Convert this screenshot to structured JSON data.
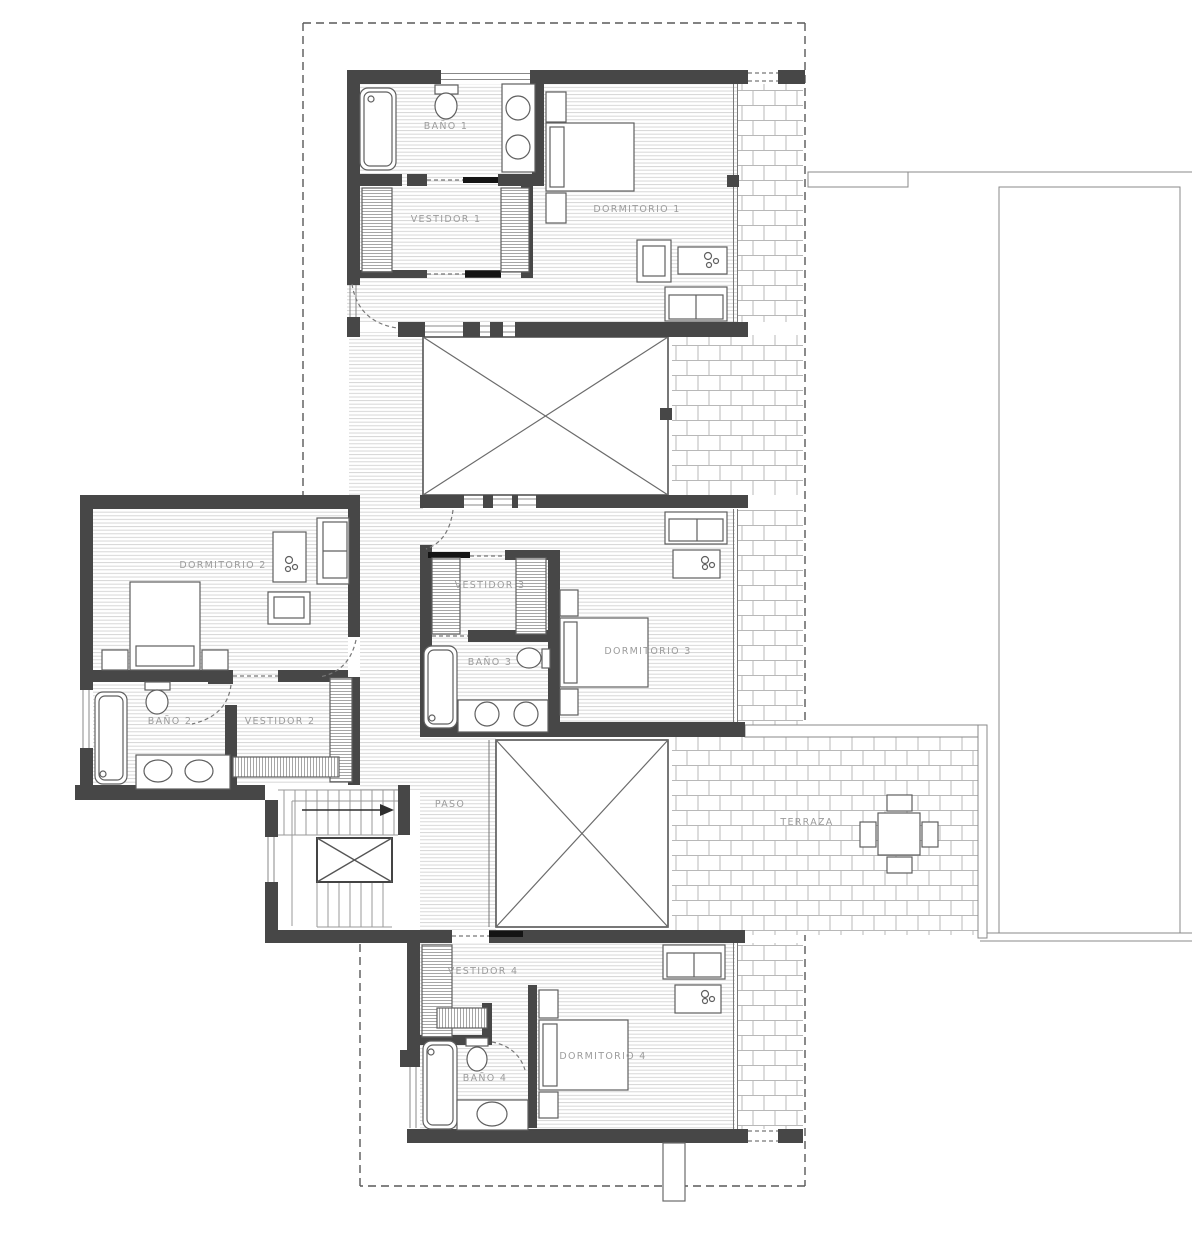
{
  "rooms": {
    "bano1": "BAÑO 1",
    "vestidor1": "VESTIDOR 1",
    "dormitorio1": "DORMITORIO 1",
    "dormitorio2": "DORMITORIO 2",
    "bano2": "BAÑO 2",
    "vestidor2": "VESTIDOR 2",
    "vestidor3": "VESTIDOR 3",
    "bano3": "BAÑO 3",
    "dormitorio3": "DORMITORIO 3",
    "paso": "PASO",
    "terraza": "TERRAZA",
    "vestidor4": "VESTIDOR 4",
    "bano4": "BAÑO 4",
    "dormitorio4": "DORMITORIO 4"
  },
  "colors": {
    "wall": "#474747",
    "door_leaf": "#141414",
    "thin_line": "#808080",
    "floor_hatch": "#d2d2d2",
    "brick_line": "#b8b8b8",
    "label": "#9c9c9c",
    "paper": "#ffffff"
  }
}
